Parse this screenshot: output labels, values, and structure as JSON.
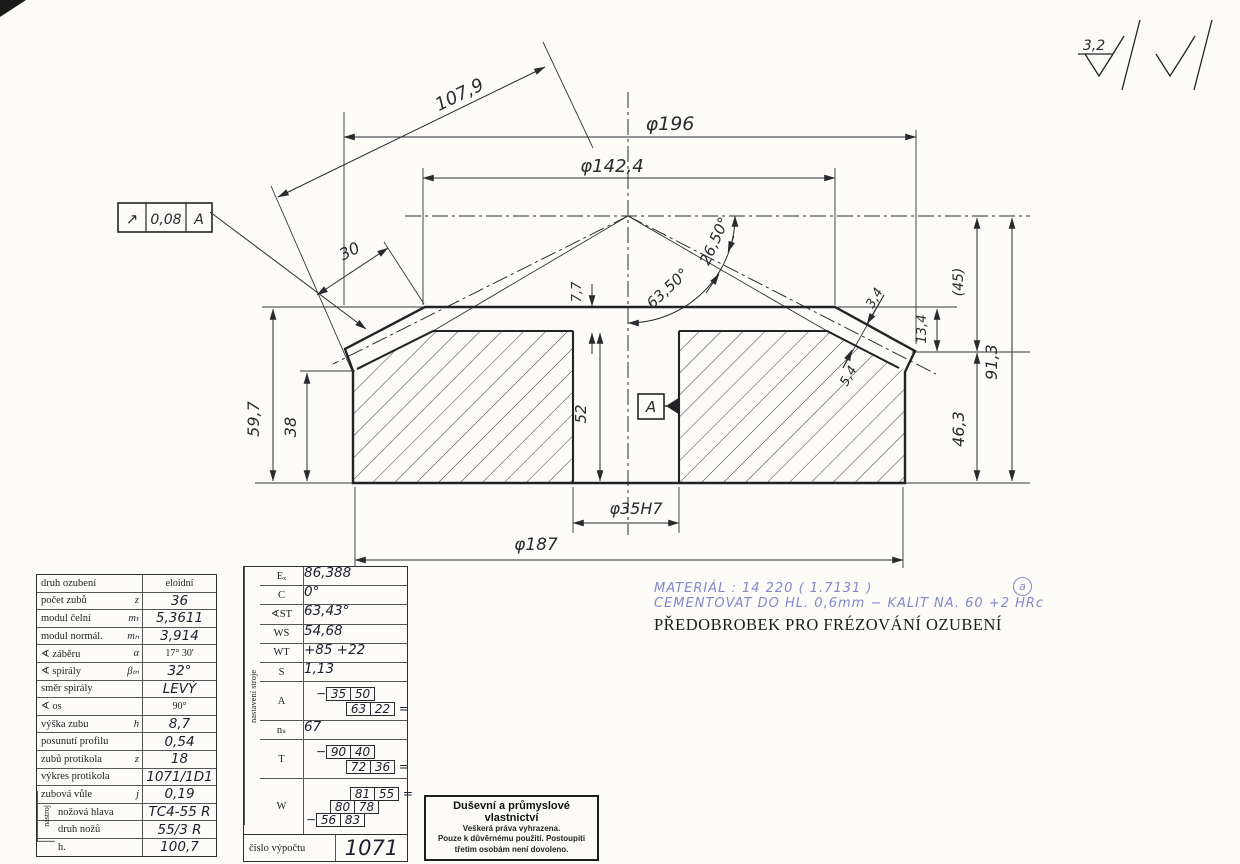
{
  "drawing": {
    "dims": {
      "d196": "φ196",
      "d142_4": "φ142,4",
      "d107_9": "107,9",
      "d30": "30",
      "d7_7": "7,7",
      "a63_50": "63,50°",
      "a26_50": "26,50°",
      "d3_4": "3,4",
      "d5_4": "5,4",
      "d13_4": "13,4",
      "d45": "(45)",
      "d91_3": "91,3",
      "d46_3": "46,3",
      "d59_7": "59,7",
      "d38": "38",
      "d52": "52",
      "d35h7": "φ35H7",
      "d187": "φ187"
    },
    "tolerance_frame": {
      "symbol": "↗",
      "value": "0,08",
      "datum": "A"
    },
    "datum_label": "A",
    "surface_finish": {
      "roughness": "3,2"
    }
  },
  "tables": {
    "gear": {
      "tool_group_label": "nástroj",
      "rows": [
        {
          "label": "druh ozubení",
          "sym": "",
          "value": "eloidní"
        },
        {
          "label": "počet zubů",
          "sym": "z",
          "value": "36"
        },
        {
          "label": "modul čelní",
          "sym": "mₜ",
          "value": "5,3611"
        },
        {
          "label": "modul normál.",
          "sym": "mₙ",
          "value": "3,914"
        },
        {
          "label": "∢ záběru",
          "sym": "α",
          "value": "17° 30'"
        },
        {
          "label": "∢ spirály",
          "sym": "βₘ",
          "value": "32°"
        },
        {
          "label": "směr spirály",
          "sym": "",
          "value": "LEVÝ"
        },
        {
          "label": "∢ os",
          "sym": "",
          "value": "90°"
        },
        {
          "label": "výška zubu",
          "sym": "h",
          "value": "8,7"
        },
        {
          "label": "posunutí profilu",
          "sym": "",
          "value": "0,54"
        },
        {
          "label": "zubů protikola",
          "sym": "z",
          "value": "18"
        },
        {
          "label": "výkres protikola",
          "sym": "",
          "value": "1071/1D1"
        },
        {
          "label": "zubová vůle",
          "sym": "j",
          "value": "0,19"
        },
        {
          "label": "nožová hlava",
          "sym": "",
          "value": "TC4-55 R"
        },
        {
          "label": "druh nožů",
          "sym": "",
          "value": "55/3 R"
        },
        {
          "label": "h.",
          "sym": "",
          "value": "100,7"
        }
      ]
    },
    "machine": {
      "side_label": "nastavení stroje",
      "rows": [
        {
          "label": "Eₓ",
          "value": "86,388"
        },
        {
          "label": "C",
          "value": "0°"
        },
        {
          "label": "∢ST",
          "value": "63,43°"
        },
        {
          "label": "WS",
          "value": "54,68"
        },
        {
          "label": "WT",
          "value": "+85  +22"
        },
        {
          "label": "S",
          "value": "1,13"
        }
      ],
      "row_a": {
        "label": "A",
        "neg": "−",
        "b1": [
          "35",
          "50"
        ],
        "b2": [
          "63",
          "22"
        ],
        "eq": "="
      },
      "row_n": {
        "label": "nₛ",
        "value": "67"
      },
      "row_t": {
        "label": "T",
        "neg": "−",
        "b1": [
          "90",
          "40"
        ],
        "b2": [
          "72",
          "36"
        ],
        "eq": "="
      },
      "row_w": {
        "label": "W",
        "b1": [
          "81",
          "55"
        ],
        "eq": "=",
        "b2": [
          "80",
          "78"
        ],
        "neg": "−",
        "b3": [
          "56",
          "83"
        ]
      },
      "footer": {
        "label": "číslo výpočtu",
        "value": "1071"
      }
    }
  },
  "notes": {
    "material": "MATERIÁL :  14 220   ( 1.7131 )",
    "treatment": "CEMENTOVAT DO HL. 0,6mm  −  KALIT NA.  60 +2 HRc",
    "title": "PŘEDOBROBEK PRO FRÉZOVÁNÍ OZUBENÍ",
    "revision_mark": "a"
  },
  "copyright": {
    "title": "Duševní a průmyslové vlastnictví",
    "line1": "Veškerá práva vyhrazena.",
    "line2": "Pouze k důvěrnému použití. Postoupiti",
    "line3": "třetím osobám není dovoleno."
  }
}
